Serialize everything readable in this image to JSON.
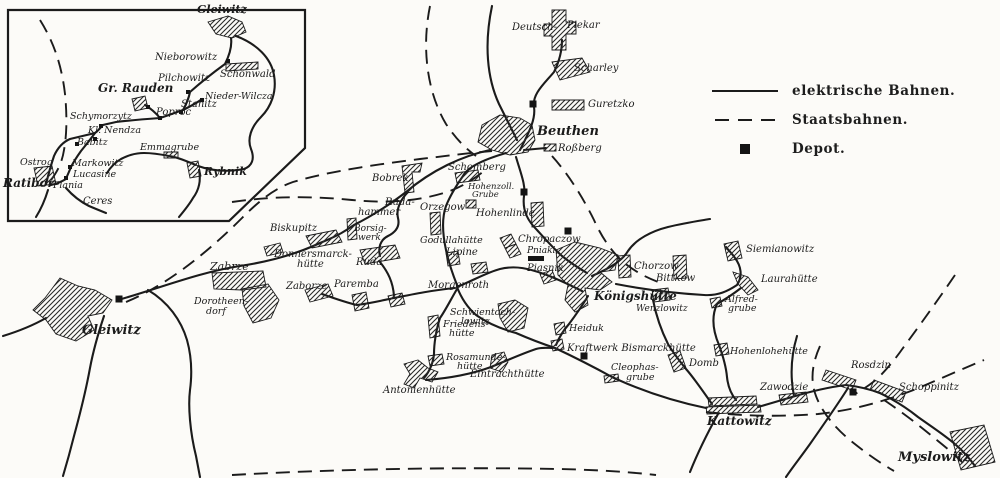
{
  "colors": {
    "paper": "#fcfbf8",
    "ink": "#1b1b1b"
  },
  "legend": {
    "items": [
      {
        "label": "elektrische Bahnen.",
        "swatch": "solid-line"
      },
      {
        "label": "Staatsbahnen.",
        "swatch": "dashed-line"
      },
      {
        "label": "Depot.",
        "swatch": "depot-square"
      }
    ]
  },
  "map": {
    "inset_frame": "8,10 305,10 305,148 229,221 8,221",
    "railways": {
      "electric": [
        "M118,300 C160,288 200,272 240,266 C280,260 305,250 320,243 C342,234 348,229 354,225 C372,216 392,203 406,192 C432,170 462,156 490,150",
        "M520,150 C528,134 536,120 534,107 C532,94 544,84 554,72 C560,60 562,50 562,40",
        "M524,150 L546,148",
        "M506,153 C482,160 467,168 463,176 C456,186 450,196 446,206 C441,220 443,236 446,250 C449,264 453,275 457,285",
        "M516,157 C521,174 526,186 524,196 C522,212 529,222 537,230 C546,240 553,248 562,256 C572,264 580,269 587,273",
        "M457,287 C474,280 488,272 500,269 C516,265 530,269 544,274 C558,279 570,285 582,291",
        "M457,287 C462,300 468,308 476,315 C490,325 505,330 516,333 C532,340 546,345 555,348 C572,356 592,366 612,377 C642,391 672,401 706,408",
        "M457,289 C450,301 445,311 440,318 C436,330 434,344 434,354 C433,364 429,372 424,378",
        "M426,380 C452,378 472,374 491,367 C506,361 521,354 536,349 C542,347 548,348 553,348",
        "M588,296 C582,306 575,316 569,324 C562,332 558,340 556,345",
        "M592,276 C610,268 622,261 628,251 C636,239 652,231 668,227 C684,223 698,221 710,219",
        "M616,284 C652,291 688,294 704,295 C718,296 728,291 737,285 C743,276 741,266 735,258 C731,252 728,250 726,247",
        "M741,288 C732,295 724,300 717,304 C711,317 713,331 719,345 C723,356 726,366 727,377 C728,387 731,394 736,400",
        "M712,404 C702,390 694,378 686,369 C678,359 672,351 668,344 C661,330 656,315 653,300",
        "M758,407 C772,403 782,400 792,397 C812,391 830,387 846,385 C862,387 872,390 880,393 C896,401 908,409 918,417 C932,427 946,436 956,445 C964,452 970,459 975,466",
        "M322,294 C336,299 348,303 357,305 C372,303 384,300 394,298 C414,294 434,290 455,288",
        "M380,262 C388,272 393,282 394,296",
        "M148,290 C168,302 181,320 187,340 C192,358 192,375 190,390 C188,406 190,432 196,456 L200,477",
        "M104,316 C98,334 93,352 90,368 C86,390 80,414 74,436 C70,452 66,466 63,476",
        "M46,318 C32,326 16,332 3,336",
        "M408,192 C400,200 396,210 398,218 C400,226 396,232 388,236 C380,240 378,248 380,256",
        "M492,6 C484,44 487,78 499,104 C506,118 512,130 517,140",
        "M794,396 C790,376 791,356 797,336",
        "M848,388 C838,404 824,424 810,444 C800,458 792,468 786,477",
        "M718,414 C708,432 698,452 690,472",
        "M46,184 C49,172 52,162 54,156 C58,147 63,142 70,139 C78,137 87,135 95,133 C99,130 101,127 103,125 L116,122 C132,120 146,119 160,118 C169,115 177,112 183,110 C187,103 189,97 190,92 C199,84 214,72 225,64 C230,54 232,45 231,38",
        "M160,118 C155,112 150,108 145,105",
        "M183,110 C191,106 197,103 202,99",
        "M95,133 C90,140 85,146 81,151 C76,158 73,163 71,167 C69,172 67,176 66,179 C61,182 56,184 51,185",
        "M236,36 C257,44 271,58 274,75 C277,92 271,107 261,117 C251,127 247,139 251,149 C255,159 252,166 244,169 C228,172 212,171 198,166",
        "M196,165 C186,161 177,157 169,156 C159,154 151,153 144,153 C134,153 127,156 121,159 C114,163 110,168 107,173",
        "M199,170 C201,180 199,190 193,198 C189,205 184,211 179,217",
        "M66,188 C73,196 81,202 89,206 C96,209 101,211 106,213",
        "M48,190 C45,200 41,209 36,217"
      ],
      "staats": [
        "M126,302 C170,284 212,248 242,218 C262,198 276,188 293,182 C330,171 380,164 420,159 C446,156 468,153 492,151",
        "M232,202 C272,196 312,196 352,200 C392,204 422,200 447,192 C462,187 474,179 484,171",
        "M430,6 C421,50 428,94 446,124 C456,139 466,149 476,156",
        "M552,156 C570,176 584,200 594,220 C603,240 614,255 627,265 C639,274 650,279 661,283",
        "M706,412 C742,416 780,417 818,414 C856,410 888,400 916,389 C940,379 962,369 984,360",
        "M820,346 C812,364 810,380 816,396 C822,412 834,427 851,441 C866,453 880,463 894,471",
        "M232,475 C340,469 452,467 560,469 C600,470 630,472 656,475",
        "M884,400 C902,412 920,426 938,441 C948,449 956,456 963,463",
        "M40,20 C55,44 62,68 65,94 C67,114 67,134 64,150 C62,163 57,172 51,180",
        "M955,275 C938,300 920,325 903,348 C896,358 888,368 878,378 C870,385 862,390 855,394"
      ]
    },
    "areas": [
      {
        "id": "gleiwitz-town",
        "d": "M60,278 L78,286 L95,290 L112,300 L103,313 L88,316 L94,330 L76,341 L56,334 L46,320 L33,310 L45,298 Z"
      },
      {
        "id": "beuthen-town",
        "d": "M482,125 L500,115 L520,118 L532,125 L535,140 L528,152 L510,155 L492,150 L478,142 Z"
      },
      {
        "id": "deutsch-piekar",
        "d": "M552,10 L566,10 L566,22 L576,22 L576,34 L566,34 L566,50 L552,50 L552,36 L544,36 L544,24 L552,24 Z"
      },
      {
        "id": "scharley",
        "d": "M552,62 L582,58 L590,72 L560,80 Z"
      },
      {
        "id": "guretzko",
        "d": "M552,100 L584,100 L584,110 L552,110 Z"
      },
      {
        "id": "rossberg",
        "d": "M544,144 L556,144 L556,151 L544,151 Z"
      },
      {
        "id": "bobrek",
        "d": "M402,166 L422,163 L420,172 L412,172 L414,192 L405,193 Z"
      },
      {
        "id": "schomberg",
        "d": "M455,173 L478,170 L480,180 L457,183 Z"
      },
      {
        "id": "hohenzollerngrube",
        "d": "M466,200 L476,200 L476,208 L466,208 Z"
      },
      {
        "id": "orzegow",
        "d": "M430,213 L440,212 L441,234 L431,235 Z"
      },
      {
        "id": "hohenlinde",
        "d": "M531,203 L543,202 L544,226 L532,227 Z"
      },
      {
        "id": "borsigwerk",
        "d": "M347,219 L356,218 L357,239 L348,240 Z"
      },
      {
        "id": "biskupitz",
        "d": "M306,236 L336,230 L342,242 L312,248 Z"
      },
      {
        "id": "donnersmarckhuette",
        "d": "M264,247 L280,243 L283,252 L267,256 Z"
      },
      {
        "id": "zabrze-1",
        "d": "M212,273 L263,271 L266,287 L242,290 L214,289 Z"
      },
      {
        "id": "zabrze-2",
        "d": "M242,289 L268,284 L279,300 L271,318 L253,323 L244,306 Z"
      },
      {
        "id": "zaborze",
        "d": "M305,290 L328,284 L333,296 L310,302 Z"
      },
      {
        "id": "ruda",
        "d": "M360,250 L395,245 L400,258 L365,264 Z"
      },
      {
        "id": "paremba",
        "d": "M352,295 L366,292 L369,308 L355,311 Z"
      },
      {
        "id": "paremba-east",
        "d": "M388,296 L402,293 L405,304 L391,307 Z"
      },
      {
        "id": "godullahuette",
        "d": "M446,253 L458,251 L460,264 L448,266 Z"
      },
      {
        "id": "lipine",
        "d": "M471,264 L486,262 L488,272 L473,274 Z"
      },
      {
        "id": "chropaczow-1",
        "d": "M500,238 L511,234 L516,244 L505,248 Z"
      },
      {
        "id": "chropaczow-2",
        "d": "M505,248 L516,244 L521,254 L510,258 Z"
      },
      {
        "id": "piasnik",
        "d": "M540,274 L552,270 L556,280 L544,284 Z"
      },
      {
        "id": "chorzow",
        "d": "M618,256 L630,255 L631,277 L619,278 Z"
      },
      {
        "id": "bittkow",
        "d": "M673,256 L686,255 L687,278 L674,279 Z"
      },
      {
        "id": "siemianowitz",
        "d": "M724,244 L738,241 L742,258 L728,261 Z"
      },
      {
        "id": "laurahuette",
        "d": "M733,272 L748,277 L758,290 L748,295 L738,284 Z"
      },
      {
        "id": "alfredgrube",
        "d": "M710,299 L720,297 L722,306 L712,308 Z"
      },
      {
        "id": "hohenlohehuette",
        "d": "M714,345 L727,343 L729,354 L716,356 Z"
      },
      {
        "id": "koenigshuette-town",
        "d": "M556,250 L575,242 L600,248 L618,255 L615,270 L600,272 L612,282 L600,290 L585,288 L588,305 L575,312 L565,300 L568,285 L558,275 Z"
      },
      {
        "id": "wenzlowitz",
        "d": "M652,290 L668,288 L670,300 L654,302 Z"
      },
      {
        "id": "heiduk",
        "d": "M554,324 L564,322 L566,333 L556,335 Z"
      },
      {
        "id": "kraftwerk-bismarckhuette",
        "d": "M551,341 L562,339 L564,349 L553,351 Z"
      },
      {
        "id": "schwientochlowitz",
        "d": "M498,304 L515,300 L528,308 L524,328 L508,332 L500,318 Z"
      },
      {
        "id": "friedenshuette",
        "d": "M428,317 L438,315 L440,336 L430,338 Z"
      },
      {
        "id": "rosamundehuette",
        "d": "M428,356 L442,354 L444,364 L430,366 Z"
      },
      {
        "id": "eintrachthuette",
        "d": "M492,355 L504,352 L508,362 L502,372 L490,368 Z"
      },
      {
        "id": "antonienhuette",
        "d": "M404,364 L418,360 L428,368 L438,372 L432,382 L420,378 L414,388 L404,384 L410,374 Z"
      },
      {
        "id": "domb",
        "d": "M668,355 L680,351 L686,368 L674,372 Z"
      },
      {
        "id": "cleophasgrube",
        "d": "M604,376 L618,374 L619,381 L605,383 Z"
      },
      {
        "id": "kattowitz-1",
        "d": "M708,398 L756,396 L757,404 L709,406 Z"
      },
      {
        "id": "kattowitz-2",
        "d": "M706,407 L760,405 L761,412 L707,414 Z"
      },
      {
        "id": "zawodzie",
        "d": "M779,395 L806,392 L808,402 L781,405 Z"
      },
      {
        "id": "rosdzin",
        "d": "M826,370 L856,380 L852,390 L822,380 Z"
      },
      {
        "id": "schoppinitz",
        "d": "M874,380 L906,392 L902,402 L870,390 Z"
      },
      {
        "id": "myslowitz",
        "d": "M950,432 L984,425 L995,462 L961,470 Z"
      },
      {
        "id": "inset-gleiwitz",
        "d": "M208,22 L228,16 L242,22 L246,32 L232,38 L216,34 Z"
      },
      {
        "id": "inset-schoenwald",
        "d": "M226,64 L258,62 L258,69 L226,71 Z"
      },
      {
        "id": "inset-gr-rauden",
        "d": "M132,99 L145,96 L148,108 L135,111 Z"
      },
      {
        "id": "inset-emmagrube",
        "d": "M164,152 L178,152 L178,158 L164,158 Z"
      },
      {
        "id": "inset-rybnik",
        "d": "M187,163 L198,161 L201,176 L190,178 Z"
      },
      {
        "id": "inset-ratibor",
        "d": "M34,168 L52,166 L56,184 L38,186 Z"
      }
    ],
    "solids": [
      {
        "id": "pniaki-bar",
        "d": "M528,256 L544,256 L544,261 L528,261 Z"
      }
    ],
    "depots": [
      [
        533,
        104
      ],
      [
        524,
        192
      ],
      [
        568,
        231
      ],
      [
        119,
        299
      ],
      [
        584,
        356
      ],
      [
        853,
        392
      ]
    ],
    "stations": [
      [
        228,
        61
      ],
      [
        188,
        92
      ],
      [
        181,
        112
      ],
      [
        202,
        100
      ],
      [
        101,
        126
      ],
      [
        95,
        139
      ],
      [
        77,
        144
      ],
      [
        70,
        167
      ],
      [
        66,
        178
      ],
      [
        160,
        118
      ],
      [
        148,
        107
      ]
    ],
    "labels": [
      {
        "t": "Deutsch-",
        "x": 512,
        "y": 30
      },
      {
        "t": "Piekar",
        "x": 567,
        "y": 28
      },
      {
        "t": "Scharley",
        "x": 574,
        "y": 71
      },
      {
        "t": "Guretzko",
        "x": 588,
        "y": 107
      },
      {
        "t": "Beuthen",
        "x": 537,
        "y": 135,
        "fs": 13,
        "b": 1
      },
      {
        "t": "Roßberg",
        "x": 558,
        "y": 151
      },
      {
        "t": "Schomberg",
        "x": 448,
        "y": 170
      },
      {
        "t": "Hohenzoll.",
        "x": 468,
        "y": 189,
        "fs": 8.5
      },
      {
        "t": "Grube",
        "x": 472,
        "y": 197,
        "fs": 8.5
      },
      {
        "t": "Bobrek",
        "x": 372,
        "y": 181
      },
      {
        "t": "Ruda-",
        "x": 385,
        "y": 205
      },
      {
        "t": "hammer",
        "x": 358,
        "y": 215
      },
      {
        "t": "Orzegow",
        "x": 420,
        "y": 210
      },
      {
        "t": "Hohenlinde",
        "x": 476,
        "y": 216
      },
      {
        "t": "Borsig-",
        "x": 354,
        "y": 231,
        "fs": 9
      },
      {
        "t": "werk",
        "x": 358,
        "y": 240,
        "fs": 9
      },
      {
        "t": "Godullahütte",
        "x": 420,
        "y": 243,
        "fs": 9.5
      },
      {
        "t": "Chropaczow",
        "x": 518,
        "y": 242
      },
      {
        "t": "Lipine",
        "x": 446,
        "y": 255
      },
      {
        "t": "Pniaki",
        "x": 527,
        "y": 253,
        "fs": 9
      },
      {
        "t": "Piasnik",
        "x": 527,
        "y": 271
      },
      {
        "t": "Biskupitz",
        "x": 270,
        "y": 231
      },
      {
        "t": "Donnersmarck-",
        "x": 274,
        "y": 257
      },
      {
        "t": "hütte",
        "x": 297,
        "y": 267
      },
      {
        "t": "Zabrze",
        "x": 210,
        "y": 270,
        "fs": 11
      },
      {
        "t": "Zaborze",
        "x": 286,
        "y": 289
      },
      {
        "t": "Ruda",
        "x": 356,
        "y": 265
      },
      {
        "t": "Paremba",
        "x": 334,
        "y": 287
      },
      {
        "t": "Dorotheen-",
        "x": 194,
        "y": 304,
        "fs": 9.5
      },
      {
        "t": "dorf",
        "x": 206,
        "y": 314,
        "fs": 9.5
      },
      {
        "t": "Gleiwitz",
        "x": 82,
        "y": 334,
        "fs": 13,
        "b": 1
      },
      {
        "t": "Morgenroth",
        "x": 428,
        "y": 288
      },
      {
        "t": "Chorzow",
        "x": 634,
        "y": 269
      },
      {
        "t": "Bittkow",
        "x": 656,
        "y": 281
      },
      {
        "t": "Siemianowitz",
        "x": 746,
        "y": 252
      },
      {
        "t": "Laurahütte",
        "x": 761,
        "y": 282
      },
      {
        "t": "Alfred-",
        "x": 725,
        "y": 302,
        "fs": 9.5
      },
      {
        "t": "grube",
        "x": 728,
        "y": 311,
        "fs": 9.5
      },
      {
        "t": "Königshütte",
        "x": 594,
        "y": 300,
        "fs": 12,
        "b": 1
      },
      {
        "t": "Wenzlowitz",
        "x": 636,
        "y": 311,
        "fs": 9
      },
      {
        "t": "Hohenlohehütte",
        "x": 730,
        "y": 354,
        "fs": 9.5
      },
      {
        "t": "Heiduk",
        "x": 569,
        "y": 331,
        "fs": 9.5
      },
      {
        "t": "Kraftwerk Bismarckhütte",
        "x": 567,
        "y": 351,
        "fs": 10
      },
      {
        "t": "Schwientoch-",
        "x": 450,
        "y": 315,
        "fs": 9.5
      },
      {
        "t": "lowitz",
        "x": 461,
        "y": 324,
        "fs": 9.5
      },
      {
        "t": "Friedens-",
        "x": 443,
        "y": 327,
        "fs": 9.5
      },
      {
        "t": "hütte",
        "x": 449,
        "y": 336,
        "fs": 9.5
      },
      {
        "t": "Rosamunde-",
        "x": 446,
        "y": 360,
        "fs": 9.5
      },
      {
        "t": "hütte",
        "x": 457,
        "y": 369,
        "fs": 9.5
      },
      {
        "t": "Eintrachthütte",
        "x": 470,
        "y": 377
      },
      {
        "t": "Antonienhütte",
        "x": 383,
        "y": 393
      },
      {
        "t": "Cleophas-",
        "x": 611,
        "y": 370,
        "fs": 9.5
      },
      {
        "t": "grube",
        "x": 626,
        "y": 380,
        "fs": 9.5
      },
      {
        "t": "Domb",
        "x": 689,
        "y": 366
      },
      {
        "t": "Zawodzie",
        "x": 760,
        "y": 390
      },
      {
        "t": "Kattowitz",
        "x": 707,
        "y": 425,
        "fs": 12,
        "b": 1
      },
      {
        "t": "Rosdzin",
        "x": 851,
        "y": 368
      },
      {
        "t": "Schoppinitz",
        "x": 899,
        "y": 390
      },
      {
        "t": "Myslowitz",
        "x": 898,
        "y": 461,
        "fs": 13,
        "b": 1
      },
      {
        "t": "Gleiwitz",
        "x": 197,
        "y": 13,
        "fs": 11,
        "b": 1
      },
      {
        "t": "Nieborowitz",
        "x": 155,
        "y": 60
      },
      {
        "t": "Schönwald",
        "x": 220,
        "y": 77
      },
      {
        "t": "Pilchowitz",
        "x": 158,
        "y": 81
      },
      {
        "t": "Gr. Rauden",
        "x": 98,
        "y": 92,
        "fs": 12,
        "b": 1
      },
      {
        "t": "Stanitz",
        "x": 181,
        "y": 107
      },
      {
        "t": "Nieder-Wilcza",
        "x": 205,
        "y": 99,
        "fs": 9.5
      },
      {
        "t": "Poproc",
        "x": 156,
        "y": 115
      },
      {
        "t": "Schymorzytz",
        "x": 70,
        "y": 119,
        "fs": 9.5
      },
      {
        "t": "Kl. Nendza",
        "x": 88,
        "y": 133,
        "fs": 9.5
      },
      {
        "t": "Babitz",
        "x": 77,
        "y": 145,
        "fs": 9.5
      },
      {
        "t": "Emmagrube",
        "x": 140,
        "y": 150,
        "fs": 9.5
      },
      {
        "t": "Ostrog",
        "x": 20,
        "y": 165,
        "fs": 9.5
      },
      {
        "t": "Markowitz",
        "x": 72,
        "y": 166,
        "fs": 9.5
      },
      {
        "t": "Lucasine",
        "x": 73,
        "y": 177,
        "fs": 9.5
      },
      {
        "t": "Ratibor",
        "x": 3,
        "y": 187,
        "fs": 12,
        "b": 1
      },
      {
        "t": "Plania",
        "x": 53,
        "y": 188,
        "fs": 9.5
      },
      {
        "t": "Rybnik",
        "x": 204,
        "y": 175,
        "fs": 11,
        "b": 1
      },
      {
        "t": "Ceres",
        "x": 83,
        "y": 204
      }
    ]
  }
}
